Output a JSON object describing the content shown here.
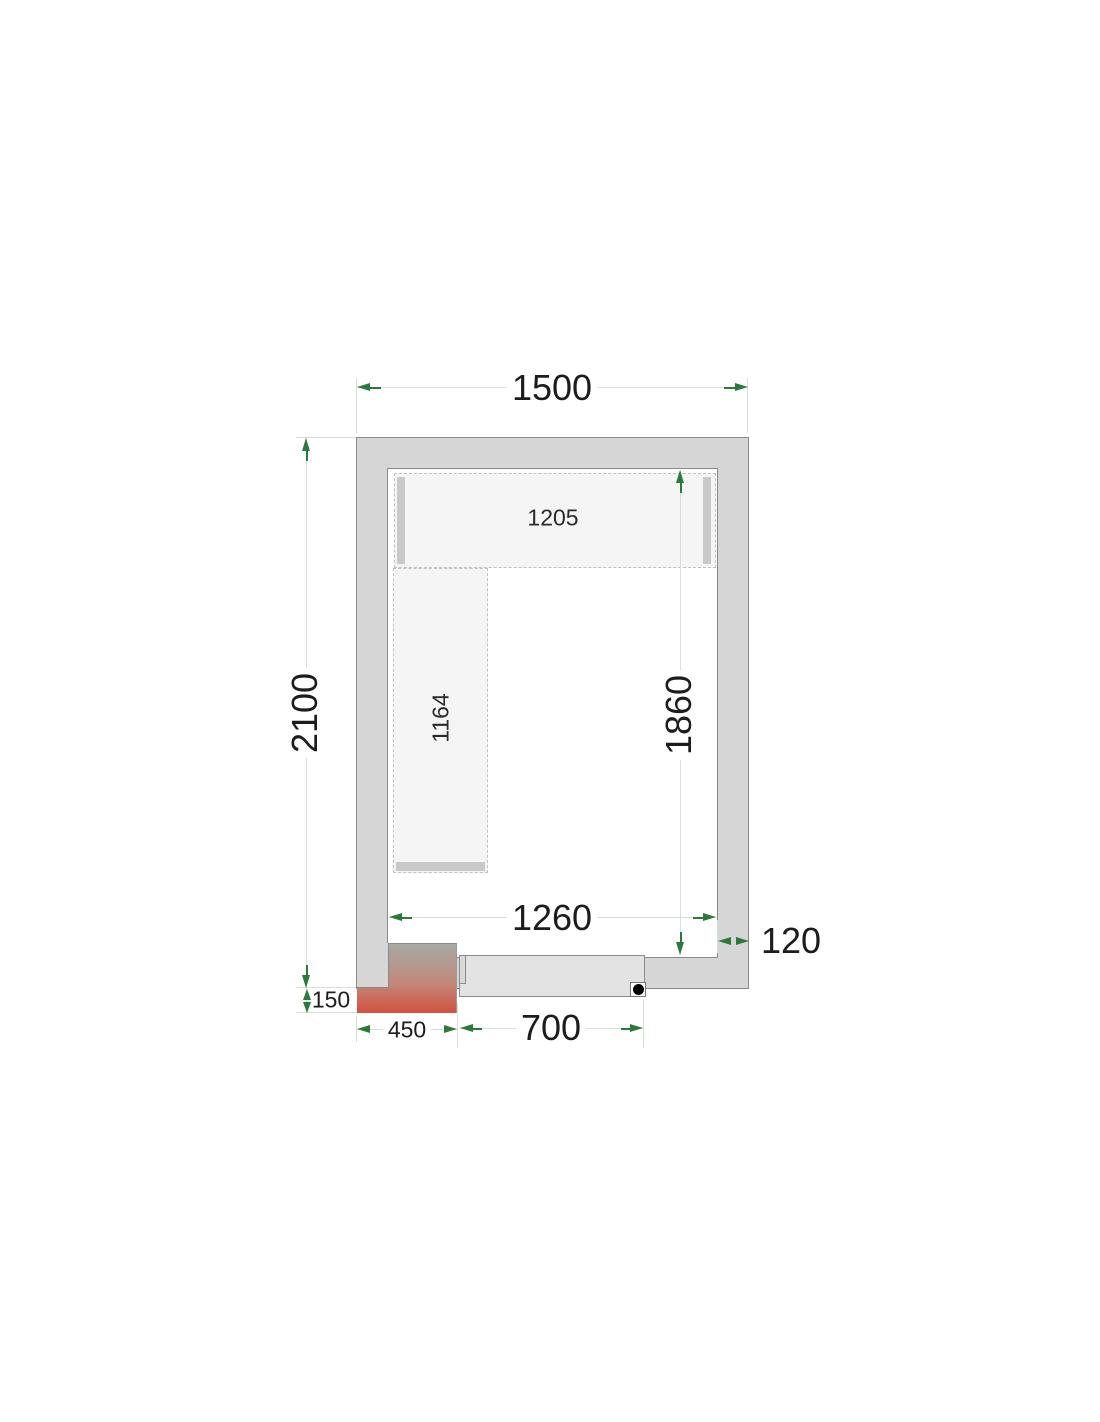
{
  "diagram": {
    "type": "cold-room-floor-plan",
    "dimensions": {
      "outer_width": "1500",
      "outer_depth": "2100",
      "inner_width": "1260",
      "inner_depth": "1860",
      "wall_thickness": "120",
      "top_shelf_length": "1205",
      "left_shelf_length": "1164",
      "unit_overhang": "150",
      "unit_width": "450",
      "door_width": "700"
    },
    "colors": {
      "wall_fill": "#d6d6d6",
      "wall_stroke": "#8a8a8a",
      "shelf_fill": "#f5f5f5",
      "shelf_dash": "#c2c2c2",
      "shelf_bar": "#c9c9c9",
      "door_fill": "#e3e3e3",
      "unit_gradient_top": "#a5aaa4",
      "unit_gradient_bottom": "#d4513e",
      "dimension_line": "#d3e2d5",
      "arrow": "#2b7a3a",
      "text": "#1c1c1c",
      "hinge_dot": "#000000"
    }
  }
}
